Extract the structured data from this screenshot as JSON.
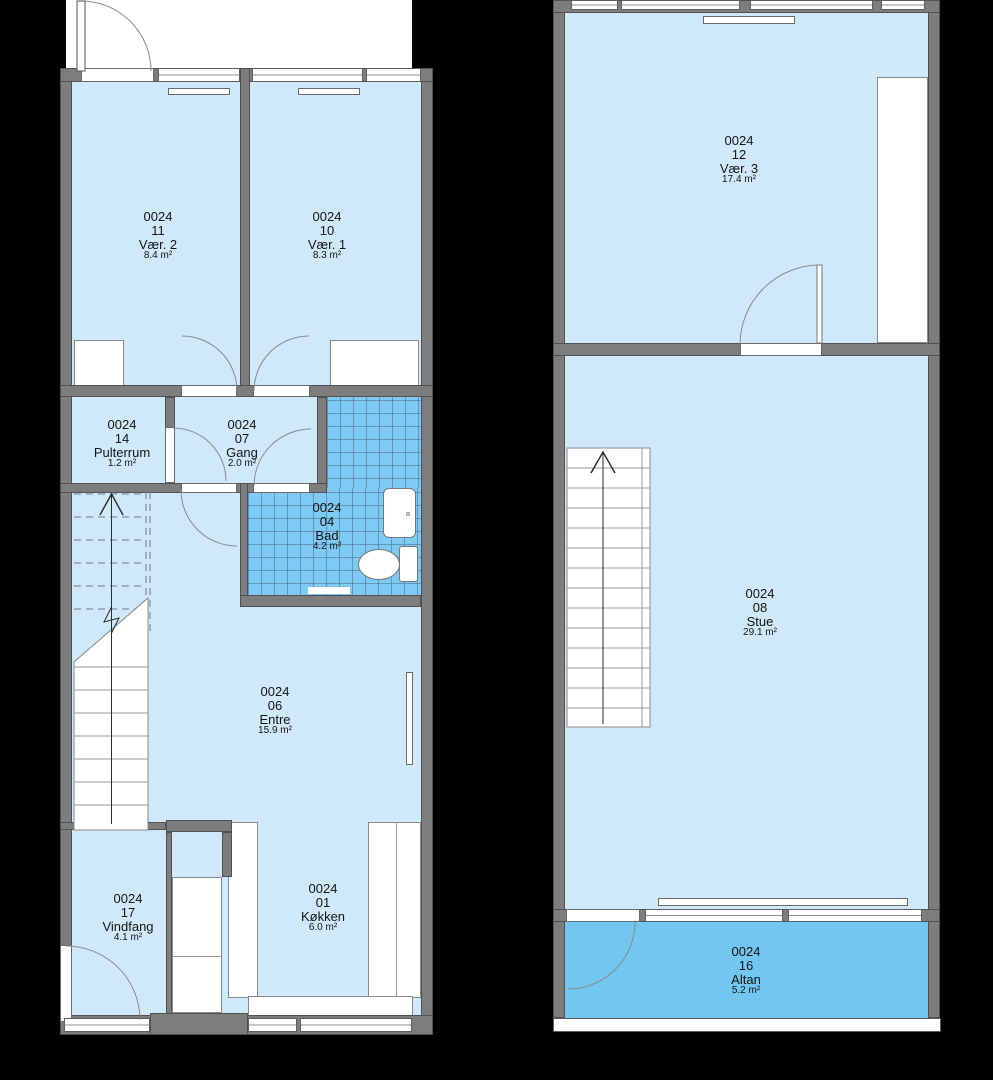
{
  "unit_code": "0024",
  "colors": {
    "background": "#000000",
    "exterior": "#ffffff",
    "wall": "#7d7d7d",
    "room_fill": "#cfe9fb",
    "bath_tile_fill": "#7dcaf4",
    "balcony_fill": "#73c6ef"
  },
  "floors": {
    "ground": {
      "rooms": [
        {
          "code": "0024",
          "number": "11",
          "name": "Vær. 2",
          "area": "8.4 m²"
        },
        {
          "code": "0024",
          "number": "10",
          "name": "Vær. 1",
          "area": "8.3 m²"
        },
        {
          "code": "0024",
          "number": "14",
          "name": "Pulterrum",
          "area": "1.2 m²"
        },
        {
          "code": "0024",
          "number": "07",
          "name": "Gang",
          "area": "2.0 m²"
        },
        {
          "code": "0024",
          "number": "04",
          "name": "Bad",
          "area": "4.2 m²"
        },
        {
          "code": "0024",
          "number": "06",
          "name": "Entre",
          "area": "15.9 m²"
        },
        {
          "code": "0024",
          "number": "17",
          "name": "Vindfang",
          "area": "4.1 m²"
        },
        {
          "code": "0024",
          "number": "01",
          "name": "Køkken",
          "area": "6.0 m²"
        }
      ]
    },
    "upper": {
      "rooms": [
        {
          "code": "0024",
          "number": "12",
          "name": "Vær. 3",
          "area": "17.4 m²"
        },
        {
          "code": "0024",
          "number": "08",
          "name": "Stue",
          "area": "29.1 m²"
        },
        {
          "code": "0024",
          "number": "16",
          "name": "Altan",
          "area": "5.2 m²"
        }
      ]
    }
  }
}
